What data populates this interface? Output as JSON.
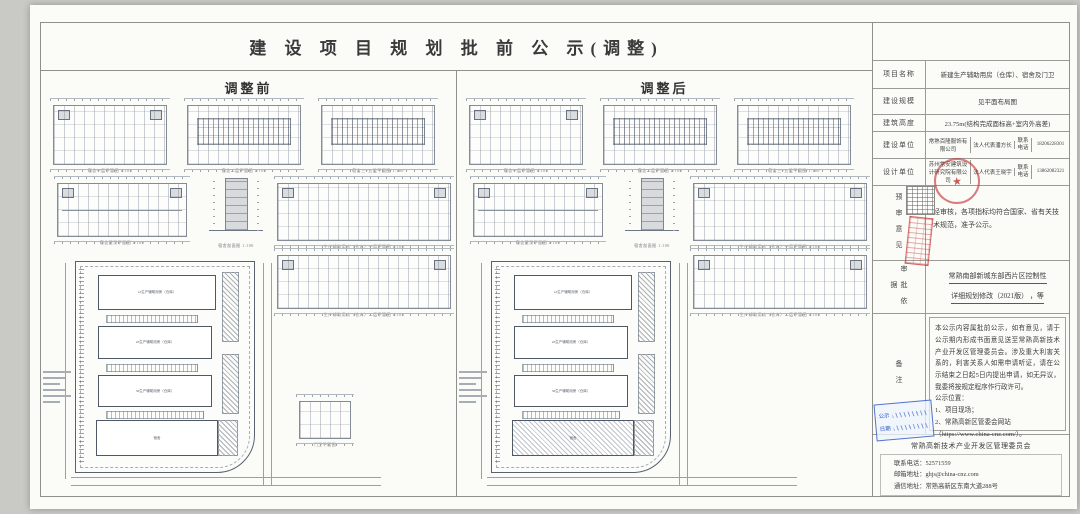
{
  "doc": {
    "title": "建 设 项 目 规 划 批 前 公 示(调整)",
    "before_header": "调整前",
    "after_header": "调整后"
  },
  "table": {
    "rows": [
      {
        "label": "项目名称",
        "value": "新建生产辅助用房（仓库）、宿舍及门卫"
      },
      {
        "label": "建设规模",
        "value": "见平面布局图"
      },
      {
        "label": "建筑高度",
        "value": "23.75m(结构完成面标高+室内外高差)"
      },
      {
        "label": "建设单位",
        "company": "常熟百隆服饰有限公司",
        "rep_label": "法人代表",
        "rep": "潘方长",
        "tel_label": "联系电话",
        "tel": "18206228301"
      },
      {
        "label": "设计单位",
        "company": "苏州常安建筑设计研究院有限公司",
        "rep_label": "法人代表",
        "rep": "王晓宇",
        "tel_label": "联系电话",
        "tel": "13862082321"
      }
    ],
    "review": {
      "label": "预审意见",
      "text": "经审核，各项指标均符合国家、省有关技术规范，准予公示。"
    },
    "basis": {
      "label": "审批依据",
      "line1": "常熟南部新城东部西片区控制性",
      "line2": "详细规划修改（2021版） ，等"
    },
    "remark": {
      "label": "备注",
      "para": "本公示内容属批前公示，如有意见，请于公示期内形成书面意见送至常熟高新技术产业开发区管理委员会。涉及重大利害关系的，利害关系人如需申请听证，请在公示结束之日起5日内提出申请，如无异议，我委将按规定程序作行政许可。",
      "loc_title": "公示位置：",
      "loc1": "1、项目现场；",
      "loc2": "2、常熟高新区管委会网站",
      "loc3": "（https://www.china-cnz.com/）。"
    }
  },
  "footer": {
    "committee": "常熟高新技术产业开发区管理委员会",
    "tel": "联系电话：52571559",
    "email": "邮箱地址：ghjs@china-cnz.com",
    "address": "通信地址：常熟高新区东南大道288号"
  },
  "stamps": {
    "circle_star": "★",
    "blue_label1": "公示",
    "blue_label2": "日期"
  },
  "drawings": {
    "captions": {
      "plan1": "宿舍一层平面图 1:100",
      "plan2": "宿舍二层平面图 1:100",
      "plan3": "宿舍三~五层平面图 1:100",
      "roof": "宿舍屋顶平面图 1:100",
      "section": "宿舍剖面图 1:100",
      "long1": "生产辅助用房（仓库）一层平面图 1:100",
      "long2": "生产辅助用房（仓库）二层平面图 1:100",
      "mini": "门卫平面图"
    },
    "site_buildings": [
      "1#生产辅助用房（仓库）",
      "2#生产辅助用房（仓库）",
      "3#生产辅助用房（仓库）",
      "宿舍"
    ]
  }
}
